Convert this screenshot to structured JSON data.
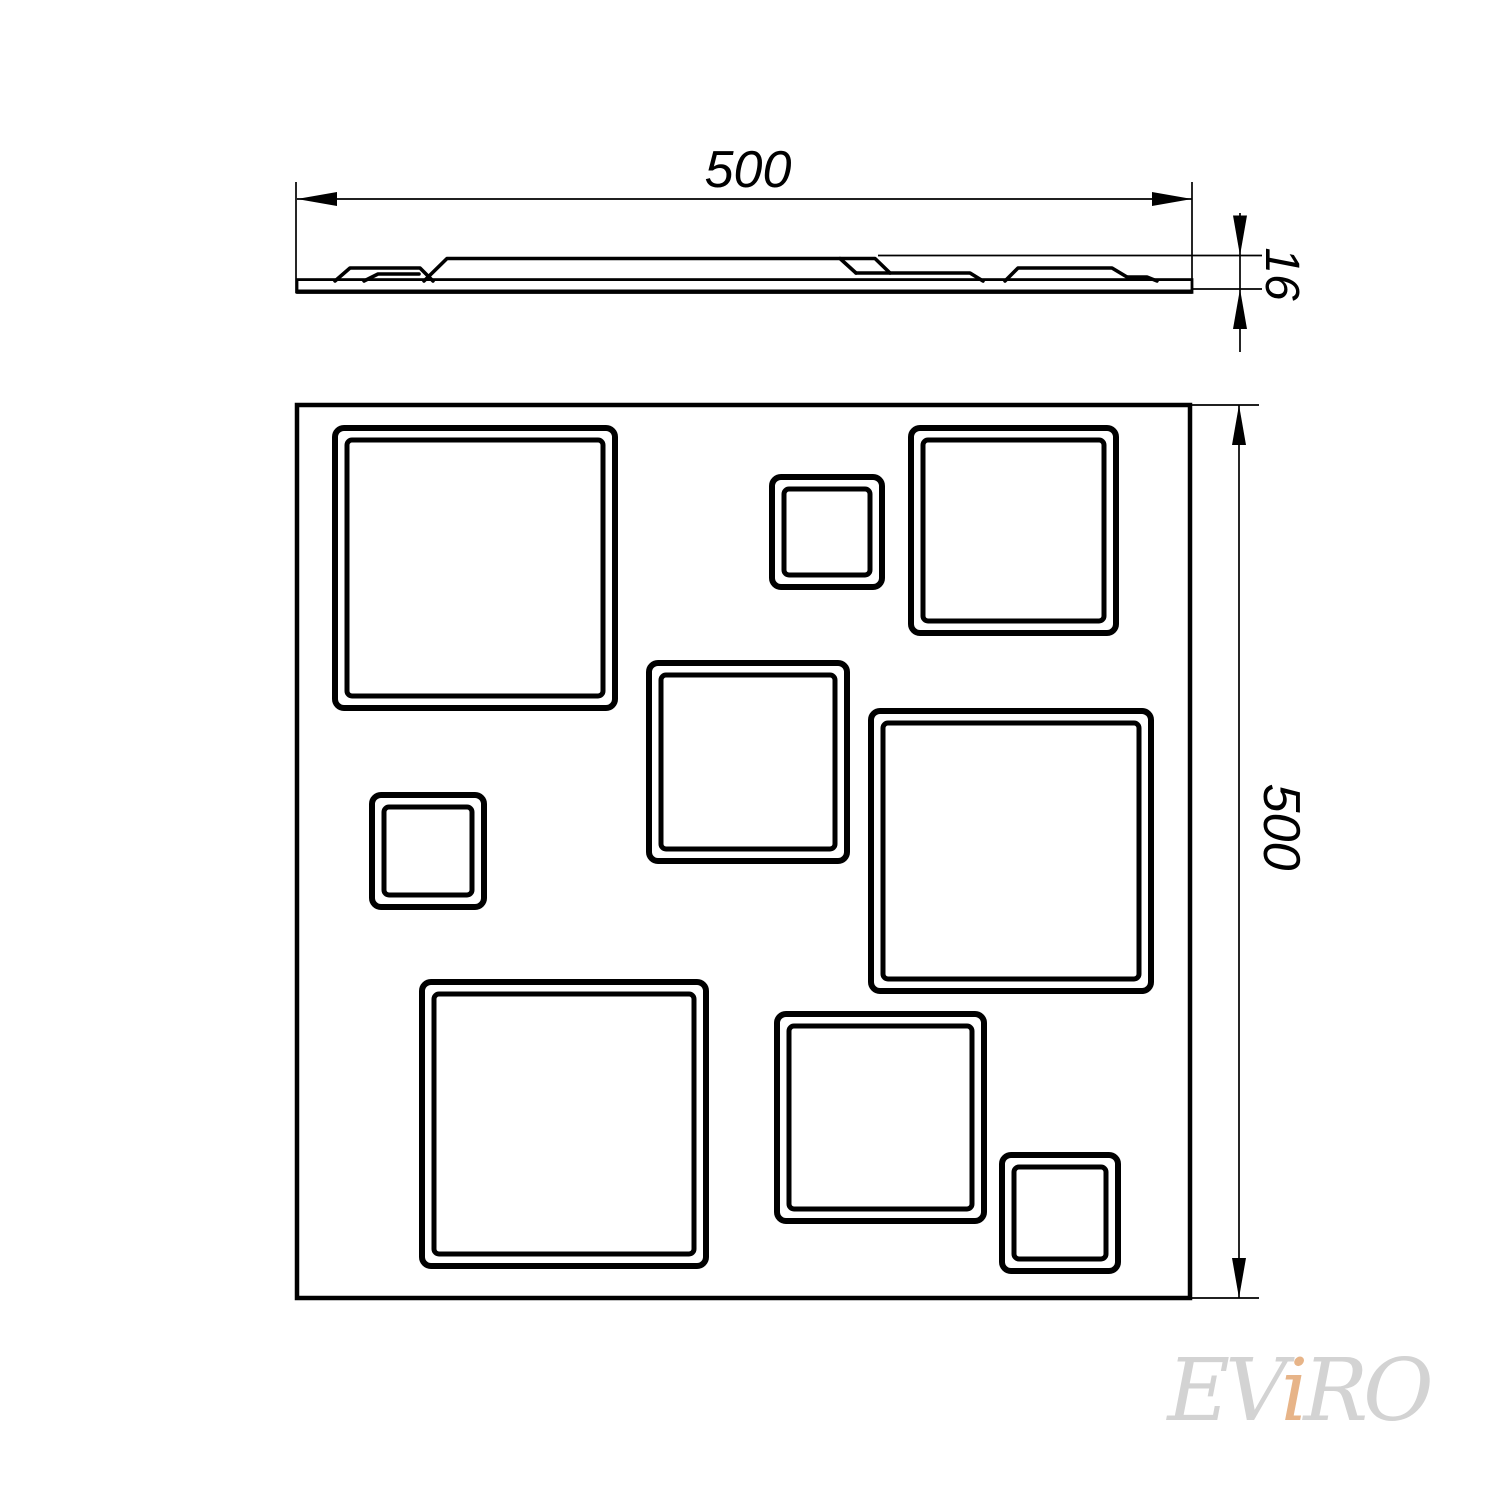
{
  "colors": {
    "line": "#000000",
    "background": "#ffffff",
    "watermark_gray": "#d3d3d3",
    "watermark_accent": "#e7b488"
  },
  "dimensions": {
    "top_width": {
      "label": "500"
    },
    "thickness": {
      "label": "16"
    },
    "side_height": {
      "label": "500"
    }
  },
  "watermark": {
    "part1": "EV",
    "accent": "i",
    "part2": "RO"
  },
  "plan_view": {
    "panel": {
      "x": 297,
      "y": 405,
      "w": 893,
      "h": 893
    },
    "squares": [
      {
        "name": "top-left-large",
        "x": 335,
        "y": 428,
        "s": 280
      },
      {
        "name": "top-center-small",
        "x": 772,
        "y": 477,
        "s": 110
      },
      {
        "name": "top-right-medium",
        "x": 911,
        "y": 428,
        "s": 205
      },
      {
        "name": "center-medium",
        "x": 649,
        "y": 663,
        "s": 198
      },
      {
        "name": "middle-left-small",
        "x": 372,
        "y": 795,
        "s": 112
      },
      {
        "name": "right-large",
        "x": 871,
        "y": 711,
        "s": 280
      },
      {
        "name": "bottom-left-large",
        "x": 422,
        "y": 982,
        "s": 284
      },
      {
        "name": "bottom-center-medium",
        "x": 777,
        "y": 1014,
        "s": 207
      },
      {
        "name": "bottom-right-small",
        "x": 1002,
        "y": 1155,
        "s": 116
      }
    ]
  },
  "profile_view": {
    "slab": {
      "x1": 297,
      "x2": 1192,
      "top": 281,
      "bottom": 291,
      "cap_top": 279.5,
      "cap_bottom": 293
    },
    "bumps": [
      "335,281 350,268 420,268 433,281",
      "364,281 378,274 419,274",
      "424,281 447,258.5 840,258.5 856,273",
      "840,258.5 875,258.5 890,273",
      "856,273 970,273 983,281",
      "1005,281 1018,268 1112,268 1127,277",
      "1127,277 1147,277 1157,281"
    ]
  },
  "dim_geometry": {
    "top_width": {
      "dim_line": {
        "x1": 297,
        "y1": 199,
        "x2": 1192,
        "y2": 199
      },
      "ext_lines": [
        {
          "x1": 296,
          "y1": 182,
          "x2": 296,
          "y2": 293
        },
        {
          "x1": 1192,
          "y1": 182,
          "x2": 1192,
          "y2": 293
        }
      ],
      "arrows": [
        {
          "x": 297,
          "y": 199,
          "angle": 180
        },
        {
          "x": 1192,
          "y": 199,
          "angle": 0
        }
      ],
      "text_pos": {
        "x": 748,
        "y": 187,
        "rotate": 0,
        "size": 52
      }
    },
    "thickness": {
      "dim_line": {
        "x1": 1240,
        "y1": 213,
        "x2": 1240,
        "y2": 352
      },
      "ext_lines": [
        {
          "x1": 878,
          "y1": 255.5,
          "x2": 1262,
          "y2": 255.5
        },
        {
          "x1": 1192,
          "y1": 289,
          "x2": 1262,
          "y2": 289
        }
      ],
      "arrows": [
        {
          "x": 1240,
          "y": 255.5,
          "angle": 90
        },
        {
          "x": 1240,
          "y": 289,
          "angle": -90
        }
      ],
      "text_pos": {
        "x": 1266,
        "y": 274,
        "rotate": 90,
        "size": 48
      }
    },
    "side_height": {
      "dim_line": {
        "x1": 1239,
        "y1": 405,
        "x2": 1239,
        "y2": 1298
      },
      "ext_lines": [
        {
          "x1": 1189,
          "y1": 405,
          "x2": 1259,
          "y2": 405
        },
        {
          "x1": 1189,
          "y1": 1298,
          "x2": 1259,
          "y2": 1298
        }
      ],
      "arrows": [
        {
          "x": 1239,
          "y": 405,
          "angle": -90
        },
        {
          "x": 1239,
          "y": 1298,
          "angle": 90
        }
      ],
      "text_pos": {
        "x": 1264,
        "y": 827,
        "rotate": 90,
        "size": 52
      }
    }
  }
}
